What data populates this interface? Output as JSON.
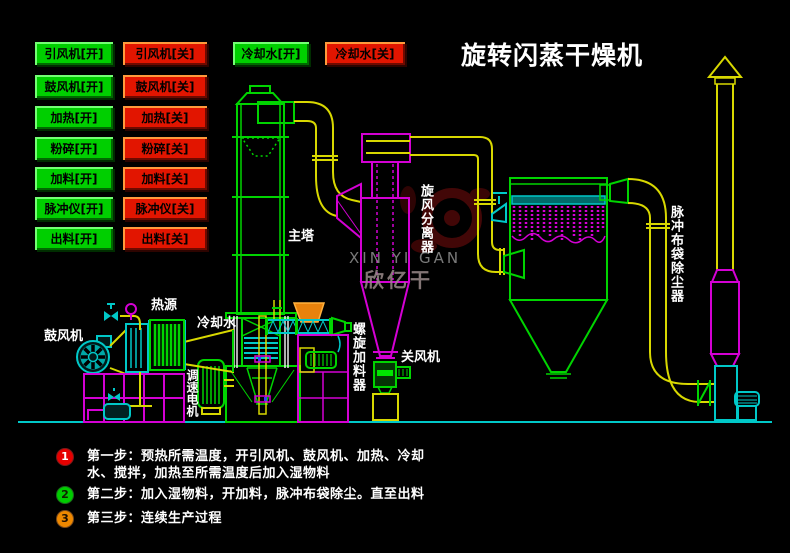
{
  "title": "旋转闪蒸干燥机",
  "controls": {
    "left_on": [
      "引风机[开]",
      "鼓风机[开]",
      "加热[开]",
      "粉碎[开]",
      "加料[开]",
      "脉冲仪[开]",
      "出料[开]"
    ],
    "left_off": [
      "引风机[关]",
      "鼓风机[关]",
      "加热[关]",
      "粉碎[关]",
      "加料[关]",
      "脉冲仪[关]",
      "出料[关]"
    ],
    "cooling_on": "冷却水[开]",
    "cooling_off": "冷却水[关]"
  },
  "labels": {
    "blower": "鼓风机",
    "heat_source": "热源",
    "cooling_water": "冷却水",
    "main_tower": "主塔",
    "cyclone": "旋风分离器",
    "screw_feeder": "螺旋加料器",
    "rotary_valve": "关风机",
    "speed_motor": "调速电机",
    "bag_filter": "脉冲布袋除尘器"
  },
  "watermark": {
    "line1": "XIN YI GAN",
    "line2": "欣亿干"
  },
  "steps": [
    {
      "num": "1",
      "text": "第一步：预热所需温度，开引风机、鼓风机、加热、冷却水、搅拌，加热至所需温度后加入湿物料"
    },
    {
      "num": "2",
      "text": "第二步：加入湿物料，开加料，脉冲布袋除尘。直至出料"
    },
    {
      "num": "3",
      "text": "第三步：连续生产过程"
    }
  ],
  "colors": {
    "background": "#000000",
    "button_on": "#00cf00",
    "button_off": "#e21500",
    "pipe_yellow": "#d8d800",
    "equipment_green": "#00d400",
    "equipment_magenta": "#d400d4",
    "equipment_cyan": "#00c8c8",
    "hopper_orange": "#e8820c",
    "title_text": "#ffffff"
  }
}
